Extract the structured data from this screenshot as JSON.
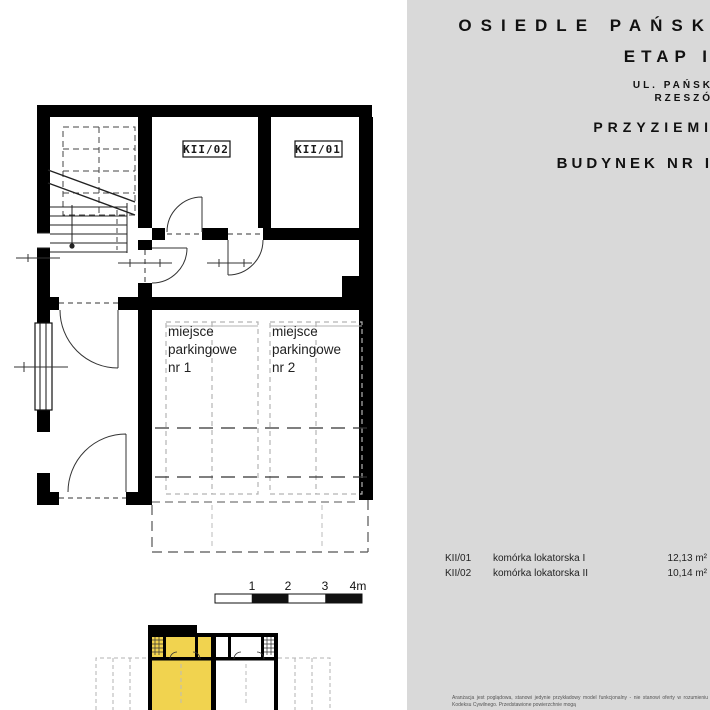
{
  "header": {
    "project_title": "OSIEDLE PAŃSK",
    "stage": "ETAP I",
    "address_line1": "UL. PAŃSK",
    "address_line2": "RZESZÓ",
    "level": "PRZYZIEMI",
    "building": "BUDYNEK NR I"
  },
  "plan": {
    "room_labels": [
      {
        "code": "KII/02"
      },
      {
        "code": "KII/01"
      }
    ],
    "parking_spaces": [
      {
        "line1": "miejsce",
        "line2": "parkingowe",
        "line3": "nr 1"
      },
      {
        "line1": "miejsce",
        "line2": "parkingowe",
        "line3": "nr 2"
      }
    ],
    "scale_bar": {
      "labels": [
        "1",
        "2",
        "3",
        "4m"
      ]
    }
  },
  "legend": {
    "rows": [
      {
        "code": "KII/01",
        "name": "komórka lokatorska I",
        "area": "12,13 m²"
      },
      {
        "code": "KII/02",
        "name": "komórka lokatorska II",
        "area": "10,14 m²"
      }
    ]
  },
  "disclaimer": {
    "line1": "Aranżacja jest poglądowa, stanowi jedynie przykładowy model funkcjonalny - nie",
    "line2": "stanowi oferty w rozumieniu Kodeksu Cywilnego. Przedstawione powierzchnie mogą"
  },
  "colors": {
    "panel_bg": "#d9d9d9",
    "plan_bg": "#ffffff",
    "wall": "#000000",
    "highlight_yellow": "#f1d34f",
    "parking_dash": "#b3b3b3"
  }
}
